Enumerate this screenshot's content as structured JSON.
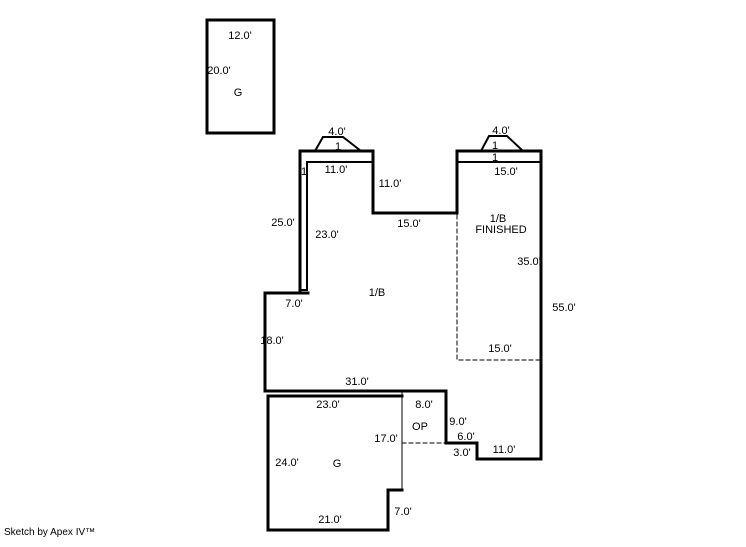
{
  "page": {
    "background": "#ffffff"
  },
  "footer": {
    "credit": "Sketch by Apex IV™"
  },
  "sketch": {
    "line_color": "#000000",
    "width": 746,
    "height": 547,
    "shapes": [
      {
        "name": "detached-garage-outline",
        "type": "polygon",
        "points": "207,20 274,20 274,133 207,133",
        "w": 3
      },
      {
        "name": "main-floor-outline",
        "type": "polygon",
        "points": "300,151 373,151 373,213 457,213 457,151 541,151 541,459 477,459 477,443 446,443 446,391 265,391 265,293 300,293",
        "w": 3
      },
      {
        "name": "bay-window-left",
        "type": "polyline",
        "points": "315,151 323,137 343,137 361,151",
        "w": 2
      },
      {
        "name": "bay-window-right",
        "type": "polyline",
        "points": "481,151 489,136 507,136 523,151",
        "w": 2
      },
      {
        "name": "basement-offset-left",
        "type": "polyline",
        "points": "371,162 307,162 307,290 300,290",
        "w": 2
      },
      {
        "name": "left-step-extension",
        "type": "polyline",
        "points": "300,293 308,293",
        "w": 3
      },
      {
        "name": "basement-offset-right",
        "type": "polyline",
        "points": "457,162 541,162",
        "w": 2
      },
      {
        "name": "garage-outline",
        "type": "polyline",
        "points": "402,396 268,396 268,530 388,530 388,490 402,490",
        "w": 3
      },
      {
        "name": "garage-right-edge",
        "type": "polyline",
        "points": "402,391 402,490",
        "w": 1
      },
      {
        "name": "open-porch-bottom-dashed",
        "type": "polyline",
        "points": "402,443 446,443",
        "w": 1,
        "dash": "4,3"
      },
      {
        "name": "finished-basement-dashed",
        "type": "polyline",
        "points": "457,215 457,360 541,360",
        "w": 1,
        "dash": "4,3"
      }
    ],
    "labels": [
      {
        "name": "dim-detached-width",
        "text": "12.0'",
        "x": 240,
        "y": 39
      },
      {
        "name": "dim-detached-depth",
        "text": "20.0'",
        "x": 219,
        "y": 74
      },
      {
        "name": "label-detached-garage",
        "text": "G",
        "x": 238,
        "y": 96
      },
      {
        "name": "dim-bay-left-width",
        "text": "4.0'",
        "x": 337,
        "y": 135
      },
      {
        "name": "label-bay-left-depth",
        "text": "1",
        "x": 338,
        "y": 150
      },
      {
        "name": "dim-bay-right-width",
        "text": "4.0'",
        "x": 501,
        "y": 134
      },
      {
        "name": "label-bay-right-depth",
        "text": "1",
        "x": 495,
        "y": 149
      },
      {
        "name": "label-right-strip",
        "text": "1",
        "x": 495,
        "y": 161
      },
      {
        "name": "dim-right-top",
        "text": "15.0'",
        "x": 506,
        "y": 175
      },
      {
        "name": "dim-left-top",
        "text": "11.0'",
        "x": 336,
        "y": 173
      },
      {
        "name": "label-left-strip",
        "text": "1",
        "x": 304,
        "y": 175
      },
      {
        "name": "dim-mid-vertical",
        "text": "11.0'",
        "x": 390,
        "y": 187
      },
      {
        "name": "dim-left-edge-upper",
        "text": "25.0'",
        "x": 283,
        "y": 226
      },
      {
        "name": "dim-basement-left",
        "text": "23.0'",
        "x": 327,
        "y": 238
      },
      {
        "name": "dim-mid-horizontal",
        "text": "15.0'",
        "x": 409,
        "y": 227
      },
      {
        "name": "label-finished-area-line1",
        "text": "1/B",
        "x": 498,
        "y": 222
      },
      {
        "name": "label-finished-area-line2",
        "text": "FINISHED",
        "x": 501,
        "y": 233
      },
      {
        "name": "dim-finished-height",
        "text": "35.0'",
        "x": 529,
        "y": 265
      },
      {
        "name": "dim-right-edge",
        "text": "55.0'",
        "x": 564,
        "y": 311
      },
      {
        "name": "dim-finished-bottom",
        "text": "15.0'",
        "x": 500,
        "y": 352
      },
      {
        "name": "label-basement-area",
        "text": "1/B",
        "x": 377,
        "y": 296
      },
      {
        "name": "dim-left-step",
        "text": "7.0'",
        "x": 294,
        "y": 307
      },
      {
        "name": "dim-left-edge-lower",
        "text": "18.0'",
        "x": 272,
        "y": 344
      },
      {
        "name": "dim-bottom-main",
        "text": "31.0'",
        "x": 357,
        "y": 385
      },
      {
        "name": "dim-garage-top",
        "text": "23.0'",
        "x": 328,
        "y": 408
      },
      {
        "name": "dim-porch-top",
        "text": "8.0'",
        "x": 424,
        "y": 408
      },
      {
        "name": "label-open-porch",
        "text": "OP",
        "x": 420,
        "y": 430
      },
      {
        "name": "dim-porch-right",
        "text": "9.0'",
        "x": 458,
        "y": 425
      },
      {
        "name": "dim-step-six",
        "text": "6.0'",
        "x": 466,
        "y": 440
      },
      {
        "name": "dim-step-three",
        "text": "3.0'",
        "x": 462,
        "y": 456
      },
      {
        "name": "dim-bottom-right",
        "text": "11.0'",
        "x": 504,
        "y": 453
      },
      {
        "name": "dim-garage-right",
        "text": "17.0'",
        "x": 386,
        "y": 442
      },
      {
        "name": "dim-garage-left",
        "text": "24.0'",
        "x": 287,
        "y": 466
      },
      {
        "name": "label-attached-garage",
        "text": "G",
        "x": 337,
        "y": 467
      },
      {
        "name": "dim-garage-bottom",
        "text": "21.0'",
        "x": 330,
        "y": 523
      },
      {
        "name": "dim-garage-notch",
        "text": "7.0'",
        "x": 403,
        "y": 515
      }
    ]
  }
}
